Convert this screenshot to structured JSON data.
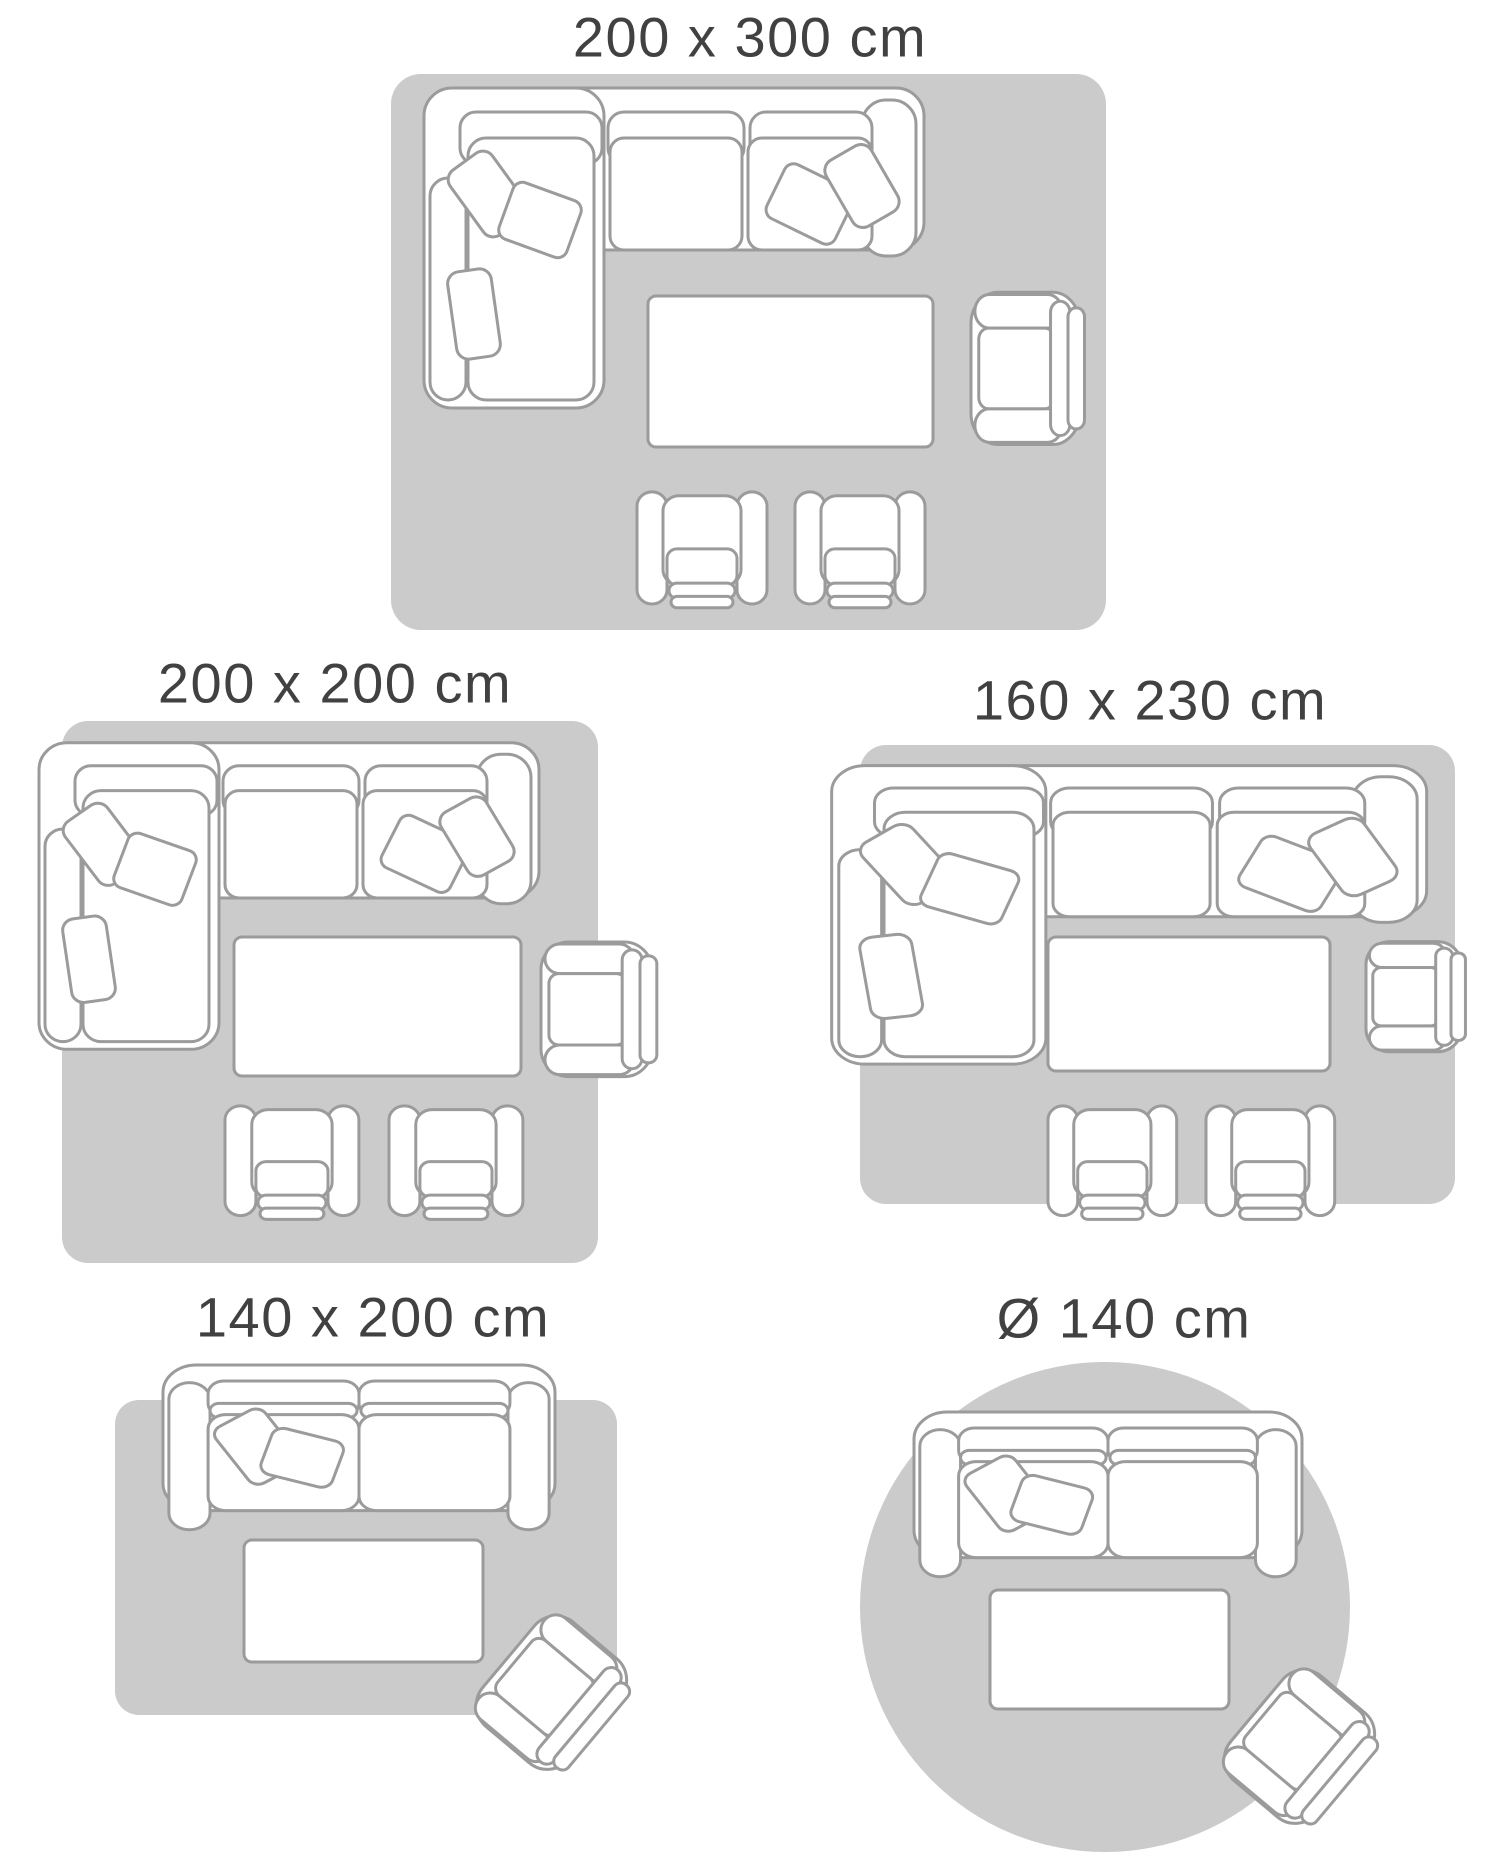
{
  "colors": {
    "background": "#ffffff",
    "rug": "#cbcbcb",
    "furniture_fill": "#ffffff",
    "furniture_stroke": "#9b9b9b",
    "label": "#414141"
  },
  "diagrams": [
    {
      "label": "200 x 300 cm",
      "shape": "rectangle",
      "width_cm": 200,
      "length_cm": 300,
      "furniture": [
        "corner-sofa",
        "coffee-table",
        "armchair",
        "armchair",
        "armchair"
      ]
    },
    {
      "label": "200 x 200 cm",
      "shape": "rectangle",
      "width_cm": 200,
      "length_cm": 200,
      "furniture": [
        "corner-sofa",
        "coffee-table",
        "armchair",
        "armchair",
        "armchair"
      ]
    },
    {
      "label": "160 x 230 cm",
      "shape": "rectangle",
      "width_cm": 160,
      "length_cm": 230,
      "furniture": [
        "corner-sofa",
        "coffee-table",
        "armchair",
        "armchair",
        "armchair"
      ]
    },
    {
      "label": "140 x 200 cm",
      "shape": "rectangle",
      "width_cm": 140,
      "length_cm": 200,
      "furniture": [
        "two-seat-sofa",
        "coffee-table",
        "armchair"
      ]
    },
    {
      "label": "Ø 140 cm",
      "shape": "circle",
      "diameter_cm": 140,
      "furniture": [
        "two-seat-sofa",
        "coffee-table",
        "armchair"
      ]
    }
  ]
}
